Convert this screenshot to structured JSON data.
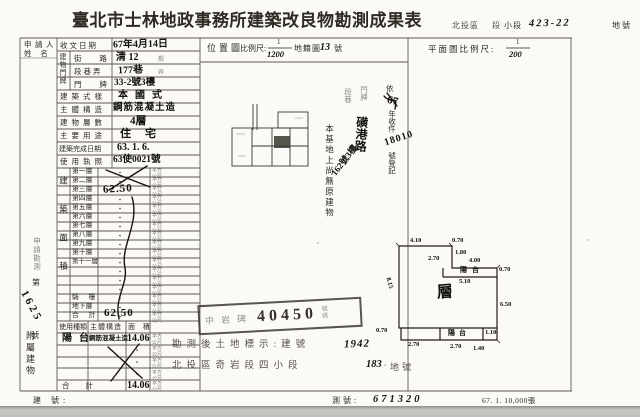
{
  "doc": {
    "title": "臺北市士林地政事務所建築改良物勘測成果表",
    "header_right": {
      "district": "北投區",
      "section_label": "段",
      "subsection_label": "小段",
      "parcel_no": "423-22",
      "parcel_unit": "地號"
    },
    "footer": {
      "left_label": "建 號:",
      "mid_label": "測號:",
      "mid_value": "671320",
      "print_info": "67. 1. 10,000張"
    }
  },
  "applicant": {
    "line1": "申請人",
    "line2": "姓 名"
  },
  "form": {
    "receive_date": {
      "label": "收文日期",
      "value": "67年4月14日"
    },
    "address": {
      "group": "建物門牌",
      "street": {
        "label": "街 路",
        "value": "清 12",
        "suffix": "鄰"
      },
      "lane": {
        "label": "段巷弄",
        "value": "177巷",
        "suffix": "弄"
      },
      "plate": {
        "label": "門 牌",
        "value": "33-2號3樓"
      }
    },
    "style": {
      "label": "建築式樣",
      "value": "本國式"
    },
    "structure": {
      "label": "主體構造",
      "value": "鋼筋混凝土造"
    },
    "floors": {
      "label": "建物層數",
      "value": "4層"
    },
    "usage": {
      "label": "主要用途",
      "value": "住宅"
    },
    "completed": {
      "label": "建築完成日期",
      "value": "63. 1. 6."
    },
    "license": {
      "label": "使用執照",
      "value": "63使0021號"
    }
  },
  "floor_area": {
    "group": "建築面積",
    "unit": "平方公尺",
    "rows": [
      "第一層",
      "第二層",
      "第三層",
      "第四層",
      "第五層",
      "第六層",
      "第七層",
      "第八層",
      "第九層",
      "第十層",
      "第十一層",
      "",
      "",
      "",
      "騎 樓",
      "地下層",
      "合 計"
    ],
    "third_floor_value": "62.50",
    "total_value": "62.50"
  },
  "annex": {
    "group": "附屬建物",
    "col_use": "使用種類",
    "col_structure": "主體構造",
    "col_area": "面 積",
    "unit": "平方公尺",
    "row1": {
      "use": "陽台",
      "structure": "鋼筋混凝土造",
      "area": "14.06"
    },
    "total_label": "合 計",
    "total_area": "14.06"
  },
  "margin_note": {
    "caption": "申請勘測",
    "no_prefix": "第",
    "number": "1625",
    "no_suffix": "號"
  },
  "location_map": {
    "label": "位置圖",
    "scale_label": "比例尺:",
    "scale_num": "1",
    "scale_den": "1200",
    "cadastral": "地籍圖",
    "sheet_no": "13",
    "sheet_unit": "號"
  },
  "registration": {
    "no_existing_note": "本基地上尚無原建物",
    "col_a": "段巷",
    "col_b": "門牌",
    "street": "磺港路",
    "address": "162號3樓",
    "recv_prefix": "依",
    "recv_year": "67",
    "recv_mid": "年收件",
    "recv_no": "18010",
    "recv_suffix": "號登記"
  },
  "plan": {
    "label": "平面圖比例尺:",
    "scale_num": "1",
    "scale_den": "200",
    "balcony_top_label": "陽台",
    "balcony_bottom_label": "陽台",
    "center_mark": "層",
    "dims": {
      "top": "4.10",
      "top_step": "0.70",
      "notch_left": "2.70",
      "notch_right": "1.80",
      "balcony_top": "4.00",
      "balcony_right": "0.70",
      "balcony_bottom": "5.10",
      "left": "8.15",
      "right": "6.50",
      "bottom_step": "0.70",
      "bottom_left": "2.70",
      "bottom_mid": "2.70",
      "right_step": "1.10",
      "bottom_right": "1.40"
    }
  },
  "stamp": {
    "left_glyphs": "中岩碑",
    "number": "40450",
    "right_glyphs": "號碼"
  },
  "survey_note": {
    "line1": "勘測後土地標示:建號",
    "line1_no": "1942",
    "line2": "北投區奇岩段四小段",
    "line2_no": "183",
    "line2_unit": "地號"
  }
}
